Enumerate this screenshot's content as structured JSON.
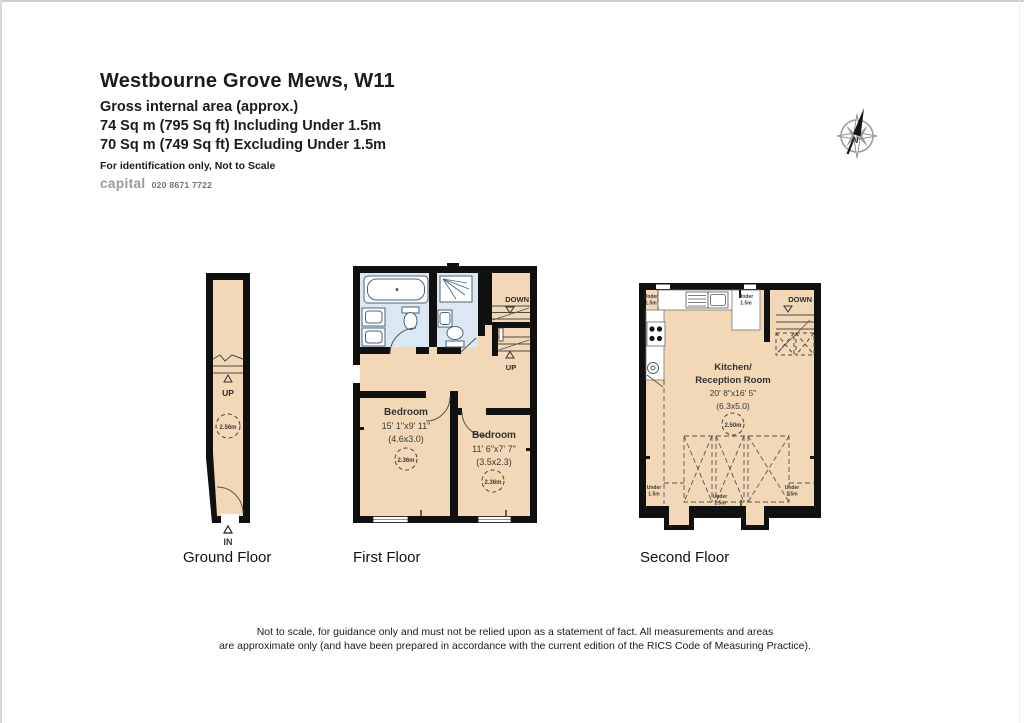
{
  "header": {
    "title": "Westbourne Grove Mews, W11",
    "subtitle": "Gross internal area (approx.)",
    "area_including": "74 Sq m (795 Sq ft) Including Under 1.5m",
    "area_excluding": "70 Sq m (749 Sq ft) Excluding Under 1.5m",
    "note": "For identification only, Not to Scale",
    "brand": "capital",
    "phone": "020 8671 7722"
  },
  "compass": {
    "north_label": "N"
  },
  "ground_floor": {
    "label": "Ground Floor",
    "up": "UP",
    "in_label": "IN",
    "height_circle": "2.56m"
  },
  "first_floor": {
    "label": "First Floor",
    "down": "DOWN",
    "up": "UP",
    "bedroom_left": {
      "name": "Bedroom",
      "dims_imperial": "15' 1\"x9' 11\"",
      "dims_metric": "(4.6x3.0)",
      "height_circle": "2.36m"
    },
    "bedroom_right": {
      "name": "Bedroom",
      "dims_imperial": "11' 6\"x7' 7\"",
      "dims_metric": "(3.5x2.3)",
      "height_circle": "2.36m"
    }
  },
  "second_floor": {
    "label": "Second Floor",
    "down": "DOWN",
    "room_name_line1": "Kitchen/",
    "room_name_line2": "Reception Room",
    "dims_imperial": "20' 8\"x16' 5\"",
    "dims_metric": "(6.3x5.0)",
    "height_circle": "2.50m",
    "under_label": {
      "line1": "Under",
      "line2": "1.5m"
    }
  },
  "footer": {
    "line1": "Not to scale, for guidance only and must not be relied upon as a statement of fact.  All measurements and areas",
    "line2": "are approximate only (and have been prepared in accordance with the current edition of the RICS Code of Measuring Practice)."
  },
  "colors": {
    "floor_fill": "#f2d8b6",
    "bath_fill": "#dbe8f4",
    "wall": "#101010"
  }
}
